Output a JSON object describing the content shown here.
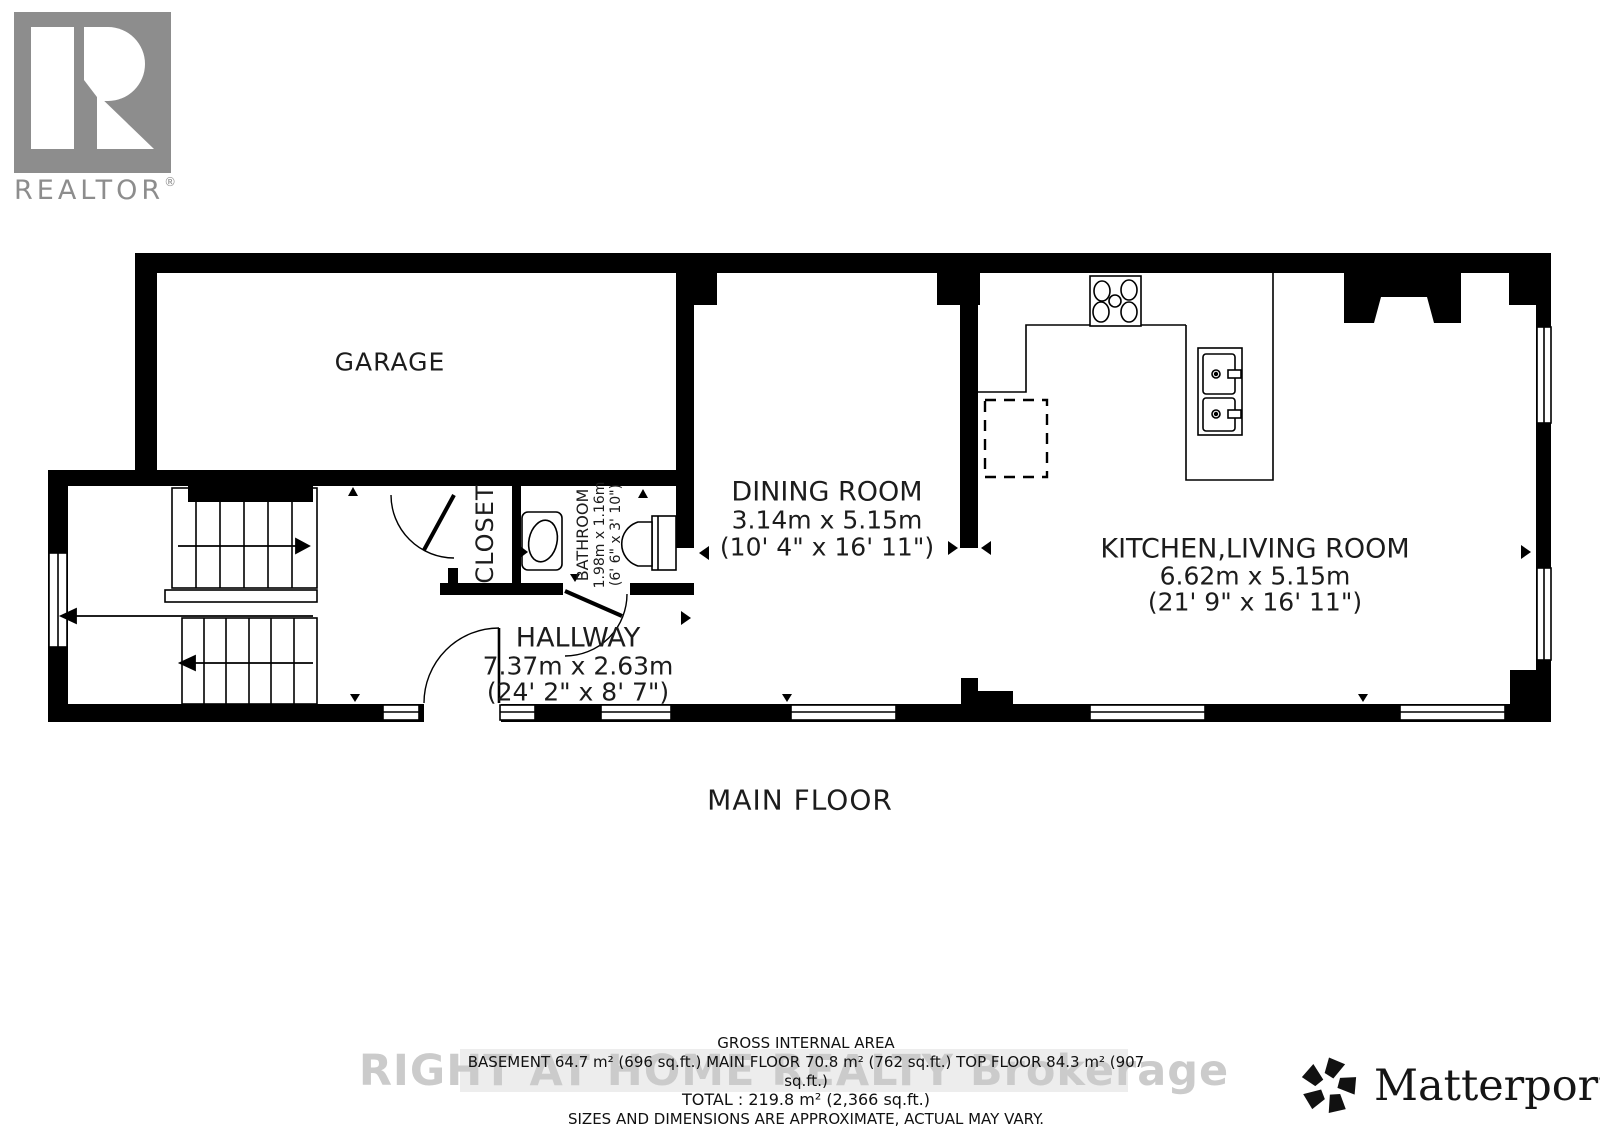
{
  "branding": {
    "realtor": {
      "name": "REALTOR",
      "reg": "®"
    },
    "matterport": {
      "name": "Matterport",
      "reg": "®"
    }
  },
  "plan": {
    "floor_label": "MAIN FLOOR",
    "rooms": {
      "garage": {
        "name": "GARAGE"
      },
      "dining": {
        "name": "DINING ROOM",
        "metric": "3.14m x 5.15m",
        "imperial": "(10' 4\" x 16' 11\")"
      },
      "kitchen_living": {
        "name": "KITCHEN,LIVING ROOM",
        "metric": "6.62m x 5.15m",
        "imperial": "(21' 9\" x 16' 11\")"
      },
      "hallway": {
        "name": "HALLWAY",
        "metric": "7.37m x 2.63m",
        "imperial": "(24' 2\" x 8' 7\")"
      },
      "closet": {
        "name": "CLOSET"
      },
      "bathroom": {
        "name": "BATHROOM",
        "metric": "1.98m x 1.16m",
        "imperial": "(6' 6\" x 3' 10\")"
      }
    }
  },
  "area_summary": {
    "title": "GROSS INTERNAL AREA",
    "breakdown": "BASEMENT 64.7 m² (696 sq.ft.)   MAIN FLOOR 70.8 m² (762 sq.ft.)   TOP FLOOR 84.3 m² (907",
    "breakdown_cont": "sq.ft.)",
    "total": "TOTAL :  219.8 m² (2,366 sq.ft.)",
    "disclaimer": "SIZES AND DIMENSIONS ARE APPROXIMATE, ACTUAL MAY VARY."
  },
  "watermark": "RIGHT AT HOME REALTY Brokerage",
  "colors": {
    "wall": "#000000",
    "logo_gray": "#8d8d8d",
    "watermark_gray": "#cbcbcb",
    "band_gray": "#ededed"
  }
}
